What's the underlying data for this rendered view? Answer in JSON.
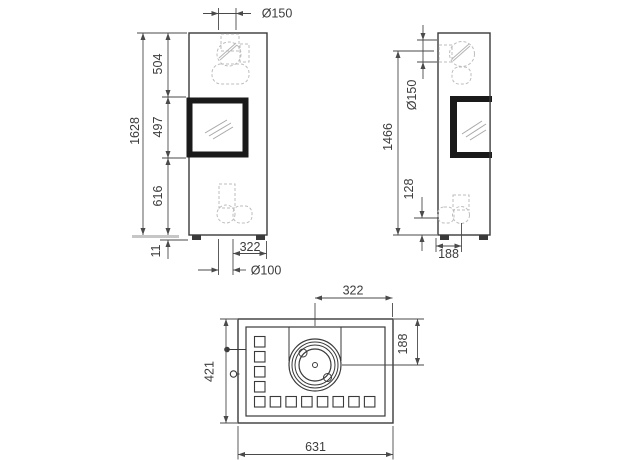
{
  "front_view": {
    "flue_diameter": "Ø150",
    "overall_height": "1628",
    "upper_section_height": "504",
    "window_height": "497",
    "lower_section_height": "616",
    "base_height": "11",
    "air_inlet_offset": "322",
    "air_inlet_diameter": "Ø100"
  },
  "side_view": {
    "flue_center_height": "1466",
    "flue_diameter": "Ø150",
    "air_inlet_center_height": "128",
    "flue_center_from_back": "188"
  },
  "top_view": {
    "flue_center_from_right": "322",
    "flue_center_from_back": "188",
    "overall_depth": "421",
    "overall_width": "631"
  }
}
